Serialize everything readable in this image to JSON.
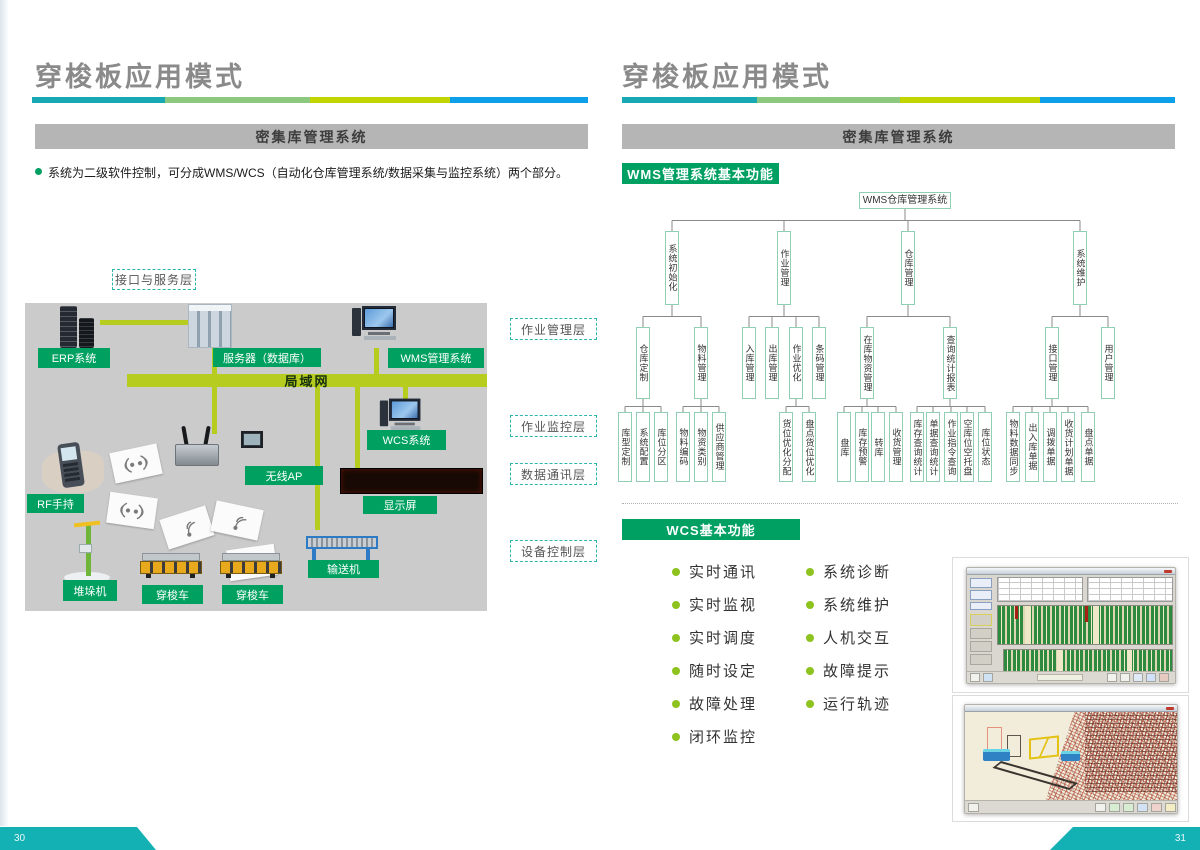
{
  "pages": {
    "left": {
      "title": "穿梭板应用模式",
      "banner": "密集库管理系统",
      "intro_bullet": "系统为二级软件控制，可分成WMS/WCS（自动化仓库管理系统/数据采集与监控系统）两个部分。",
      "interface_layer_label": "接口与服务层",
      "layer_labels": [
        "作业管理层",
        "作业监控层",
        "数据通讯层",
        "设备控制层"
      ],
      "diagram": {
        "erp": "ERP系统",
        "server": "服务器（数据库）",
        "wms": "WMS管理系统",
        "lan": "局域网",
        "wcs": "WCS系统",
        "ap": "无线AP",
        "display": "显示屏",
        "rf": "RF手持",
        "stacker": "堆垛机",
        "shuttle_a": "穿梭车",
        "shuttle_b": "穿梭车",
        "conveyor": "输送机"
      },
      "page_number": "30"
    },
    "right": {
      "title": "穿梭板应用模式",
      "banner": "密集库管理系统",
      "wms_section": "WMS管理系统基本功能",
      "wcs_section": "WCS基本功能",
      "wcs_features_left": [
        "实时通讯",
        "实时监视",
        "实时调度",
        "随时设定",
        "故障处理",
        "闭环监控"
      ],
      "wcs_features_right": [
        "系统诊断",
        "系统维护",
        "人机交互",
        "故障提示",
        "运行轨迹"
      ],
      "page_number": "31"
    }
  },
  "org_chart": {
    "nodes": [
      {
        "id": "root",
        "label": "WMS仓库管理系统",
        "cx": 905,
        "top": 192,
        "w": 92,
        "h": 17,
        "dir": "h"
      },
      {
        "id": "init",
        "parent": "root",
        "label": "系统初始化",
        "cx": 672,
        "top": 231,
        "w": 14,
        "h": 74
      },
      {
        "id": "job",
        "parent": "root",
        "label": "作业管理",
        "cx": 784,
        "top": 231,
        "w": 14,
        "h": 74
      },
      {
        "id": "wh",
        "parent": "root",
        "label": "仓库管理",
        "cx": 908,
        "top": 231,
        "w": 14,
        "h": 74
      },
      {
        "id": "maint",
        "parent": "root",
        "label": "系统维护",
        "cx": 1080,
        "top": 231,
        "w": 14,
        "h": 74
      },
      {
        "id": "whdef",
        "parent": "init",
        "label": "仓库定制",
        "cx": 643,
        "top": 327,
        "w": 14,
        "h": 72
      },
      {
        "id": "matmgmt",
        "parent": "init",
        "label": "物料管理",
        "cx": 701,
        "top": 327,
        "w": 14,
        "h": 72
      },
      {
        "id": "inbound",
        "parent": "job",
        "label": "入库管理",
        "cx": 749,
        "top": 327,
        "w": 14,
        "h": 72
      },
      {
        "id": "outbound",
        "parent": "job",
        "label": "出库管理",
        "cx": 772,
        "top": 327,
        "w": 14,
        "h": 72
      },
      {
        "id": "jobopt",
        "parent": "job",
        "label": "作业优化",
        "cx": 796,
        "top": 327,
        "w": 14,
        "h": 72
      },
      {
        "id": "barcode",
        "parent": "job",
        "label": "条码管理",
        "cx": 819,
        "top": 327,
        "w": 14,
        "h": 72
      },
      {
        "id": "stockmat",
        "parent": "wh",
        "label": "在库物资管理",
        "cx": 867,
        "top": 327,
        "w": 14,
        "h": 72
      },
      {
        "id": "query",
        "parent": "wh",
        "label": "查询统计报表",
        "cx": 950,
        "top": 327,
        "w": 14,
        "h": 72
      },
      {
        "id": "iface",
        "parent": "maint",
        "label": "接口管理",
        "cx": 1052,
        "top": 327,
        "w": 14,
        "h": 72
      },
      {
        "id": "user",
        "parent": "maint",
        "label": "用户管理",
        "cx": 1108,
        "top": 327,
        "w": 14,
        "h": 72
      },
      {
        "id": "l1",
        "parent": "whdef",
        "label": "库型定制",
        "cx": 625,
        "top": 412,
        "w": 14,
        "h": 70
      },
      {
        "id": "l2",
        "parent": "whdef",
        "label": "系统配置",
        "cx": 643,
        "top": 412,
        "w": 14,
        "h": 70
      },
      {
        "id": "l3",
        "parent": "whdef",
        "label": "库位分区",
        "cx": 661,
        "top": 412,
        "w": 14,
        "h": 70
      },
      {
        "id": "l4",
        "parent": "matmgmt",
        "label": "物料编码",
        "cx": 683,
        "top": 412,
        "w": 14,
        "h": 70
      },
      {
        "id": "l5",
        "parent": "matmgmt",
        "label": "物资类别",
        "cx": 701,
        "top": 412,
        "w": 14,
        "h": 70
      },
      {
        "id": "l6",
        "parent": "matmgmt",
        "label": "供应商管理",
        "cx": 719,
        "top": 412,
        "w": 14,
        "h": 70
      },
      {
        "id": "l7",
        "parent": "jobopt",
        "label": "货位优化分配",
        "cx": 786,
        "top": 412,
        "w": 14,
        "h": 70
      },
      {
        "id": "l8",
        "parent": "jobopt",
        "label": "盘点货位优化",
        "cx": 809,
        "top": 412,
        "w": 14,
        "h": 70
      },
      {
        "id": "l9",
        "parent": "stockmat",
        "label": "盘库",
        "cx": 844,
        "top": 412,
        "w": 14,
        "h": 70
      },
      {
        "id": "l10",
        "parent": "stockmat",
        "label": "库存预警",
        "cx": 862,
        "top": 412,
        "w": 14,
        "h": 70
      },
      {
        "id": "l11",
        "parent": "stockmat",
        "label": "转库",
        "cx": 878,
        "top": 412,
        "w": 14,
        "h": 70
      },
      {
        "id": "l12",
        "parent": "stockmat",
        "label": "收货管理",
        "cx": 896,
        "top": 412,
        "w": 14,
        "h": 70
      },
      {
        "id": "l13",
        "parent": "query",
        "label": "库存查询统计",
        "cx": 917,
        "top": 412,
        "w": 14,
        "h": 70
      },
      {
        "id": "l14",
        "parent": "query",
        "label": "单据查询统计",
        "cx": 933,
        "top": 412,
        "w": 14,
        "h": 70
      },
      {
        "id": "l15",
        "parent": "query",
        "label": "作业指令查询",
        "cx": 951,
        "top": 412,
        "w": 14,
        "h": 70
      },
      {
        "id": "l16",
        "parent": "query",
        "label": "空库位空托盘",
        "cx": 967,
        "top": 412,
        "w": 14,
        "h": 70
      },
      {
        "id": "l17",
        "parent": "query",
        "label": "库位状态",
        "cx": 985,
        "top": 412,
        "w": 14,
        "h": 70
      },
      {
        "id": "l18",
        "parent": "iface",
        "label": "物料数据同步",
        "cx": 1013,
        "top": 412,
        "w": 14,
        "h": 70
      },
      {
        "id": "l19",
        "parent": "iface",
        "label": "出入库单据",
        "cx": 1032,
        "top": 412,
        "w": 14,
        "h": 70
      },
      {
        "id": "l20",
        "parent": "iface",
        "label": "调拨单据",
        "cx": 1050,
        "top": 412,
        "w": 14,
        "h": 70
      },
      {
        "id": "l21",
        "parent": "iface",
        "label": "收货计划单据",
        "cx": 1068,
        "top": 412,
        "w": 14,
        "h": 70
      },
      {
        "id": "l22",
        "parent": "iface",
        "label": "盘点单据",
        "cx": 1088,
        "top": 412,
        "w": 14,
        "h": 70
      }
    ]
  },
  "colors": {
    "accent_teal": "#17a9b4",
    "accent_green": "#8cc87e",
    "accent_lime": "#c2d500",
    "accent_blue": "#0d9fe8",
    "label_green": "#00a160",
    "section_green": "#00a063",
    "banner_gray": "#b5b5b5",
    "bullet_green": "#8dc21f",
    "node_border": "#8fd0b5",
    "footer_teal": "#13b0b4",
    "lan_bar": "#b6cc1e"
  }
}
